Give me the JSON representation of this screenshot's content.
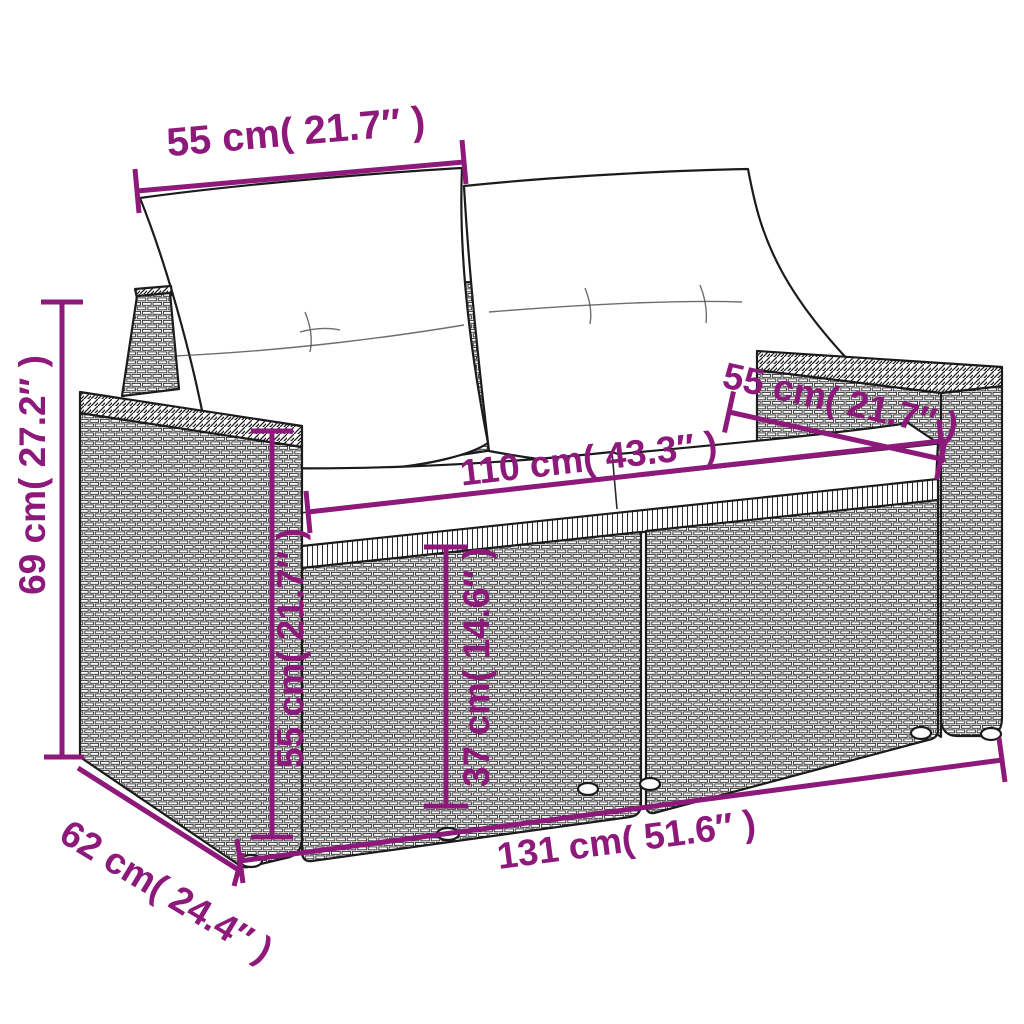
{
  "diagram": {
    "subject": "poly-rattan-2-seater-garden-sofa-with-cushions",
    "accent_color": "#8D1A7B",
    "line_color": "#1b1b1b",
    "dimensions": {
      "backrest_width": "55 cm( 21.7″ )",
      "overall_height": "69 cm( 27.2″ )",
      "seat_depth": "55 cm( 21.7″ )",
      "seat_width": "110 cm( 43.3″ )",
      "armrest_height": "55 cm( 21.7″ )",
      "seat_height": "37 cm( 14.6″ )",
      "overall_width": "131 cm( 51.6″ )",
      "overall_depth": "62 cm( 24.4″ )"
    }
  }
}
